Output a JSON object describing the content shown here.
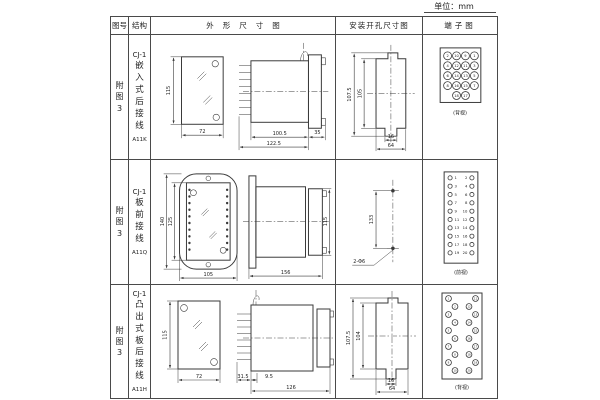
{
  "page": {
    "unit_label": "单位：mm"
  },
  "colors": {
    "line": "#3a3a3a",
    "background": "#ffffff",
    "text": "#222222"
  },
  "header": {
    "fig_no": "图号",
    "structure": "结构",
    "outline": "外形尺寸图",
    "install": "安装开孔尺寸图",
    "terminal": "端子图"
  },
  "rows": [
    {
      "fig_no": "附图3",
      "series": "CJ-1",
      "structure": "嵌入式后接线",
      "model": "A11K",
      "outline": {
        "h": "115",
        "w": "72",
        "body": "100.5",
        "total": "122.5",
        "flange": "35"
      },
      "install": {
        "outer_h": "107.5",
        "inner_h": "105",
        "slot_w": "16",
        "outer_w": "64"
      },
      "terminal": {
        "caption": "(背视)",
        "type": "grid",
        "grid": [
          [
            "2",
            "10",
            "9",
            "1"
          ],
          [
            "4",
            "12",
            "11",
            "3"
          ],
          [
            "6",
            "14",
            "13",
            "5"
          ],
          [
            "8",
            "16",
            "15",
            "7"
          ],
          [
            "",
            "18",
            "17",
            ""
          ]
        ]
      }
    },
    {
      "fig_no": "附图3",
      "series": "CJ-1",
      "structure": "板前接线",
      "model": "A11Q",
      "outline": {
        "outer_h": "140",
        "inner_h": "125",
        "w": "105",
        "len": "156",
        "side_h": "115"
      },
      "install": {
        "pitch": "133",
        "holes": "2-Φ6"
      },
      "terminal": {
        "caption": "(前视)",
        "type": "columns",
        "left": [
          "1",
          "3",
          "5",
          "7",
          "9",
          "11",
          "13",
          "15",
          "17",
          "19"
        ],
        "right": [
          "2",
          "4",
          "6",
          "8",
          "10",
          "12",
          "14",
          "16",
          "18",
          "20"
        ]
      }
    },
    {
      "fig_no": "附图3",
      "series": "CJ-1",
      "structure": "凸出式板后接线",
      "model": "A11H",
      "outline": {
        "h": "115",
        "w": "72",
        "pins": "31.5",
        "stub": "9.5",
        "len": "126"
      },
      "install": {
        "outer_h": "107.5",
        "inner_h": "104",
        "slot_w": "16",
        "outer_w": "64"
      },
      "terminal": {
        "caption": "(背视)",
        "type": "staggered",
        "left": [
          "1",
          "2",
          "3",
          "4",
          "5",
          "6",
          "7",
          "8",
          "9",
          "10"
        ],
        "right": [
          "11",
          "12",
          "13",
          "14",
          "15",
          "16",
          "17",
          "18",
          "19",
          "20"
        ]
      }
    }
  ]
}
